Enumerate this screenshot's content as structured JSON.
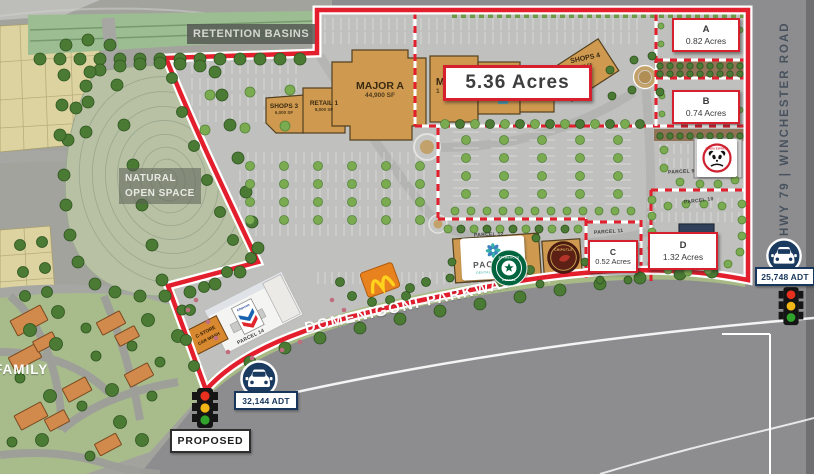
{
  "map": {
    "retention_basins": "RETENTION BASINS",
    "natural_line1": "NATURAL",
    "natural_line2": "OPEN SPACE",
    "family": "FAMILY",
    "highlight_acres": "5.36 Acres"
  },
  "buildings": {
    "shops3": {
      "name": "SHOPS 3",
      "sf": "6,000 SF"
    },
    "retail1": {
      "name": "RETAIL 1",
      "sf": "8,000 SF"
    },
    "major_a": {
      "name": "MAJOR A",
      "sf": "44,900 SF"
    },
    "major_b_fragment": {
      "name": "MA",
      "sf": "1"
    },
    "shops4": {
      "name": "SHOPS 4",
      "sf": "00 SF"
    }
  },
  "pads": {
    "a": {
      "label": "A",
      "acres": "0.82 Acres"
    },
    "b": {
      "label": "B",
      "acres": "0.74 Acres"
    },
    "c": {
      "label": "C",
      "acres": "0.52 Acres"
    },
    "d": {
      "label": "D",
      "acres": "1.32 Acres"
    }
  },
  "parcels": {
    "p9": "PARCEL 9",
    "p10": "PARCEL 10",
    "p11": "PARCEL 11",
    "p12": "PARCEL 12",
    "p14": "PARCEL 14"
  },
  "roads": {
    "domenigoni": "DOMENIGONI PARKWAY",
    "hwy79": "HWY 79 | WINCHESTER ROAD"
  },
  "traffic": {
    "domenigoni_adt": "32,144 ADT",
    "hwy79_adt": "25,748 ADT",
    "proposed": "PROPOSED"
  },
  "tenants": {
    "pacific_line1": "PACIFIC",
    "pacific_line2": "DENTAL SERVICES",
    "starbucks_line1": "STARBUCKS",
    "starbucks_line2": "COFFEE",
    "chipotle": "CHIPOTLE",
    "panda": "PANDA EXPRESS",
    "chevron": "Chevron",
    "cstore_line1": "C-STORE",
    "cstore_line2": "CAR WASH"
  },
  "colors": {
    "boundary_red": "#e31e2d",
    "adt_navy": "#17365c",
    "building_tan": "#cf9a50",
    "open_space_green": "#b8c1a4",
    "road_gray": "#8d8d8f"
  }
}
